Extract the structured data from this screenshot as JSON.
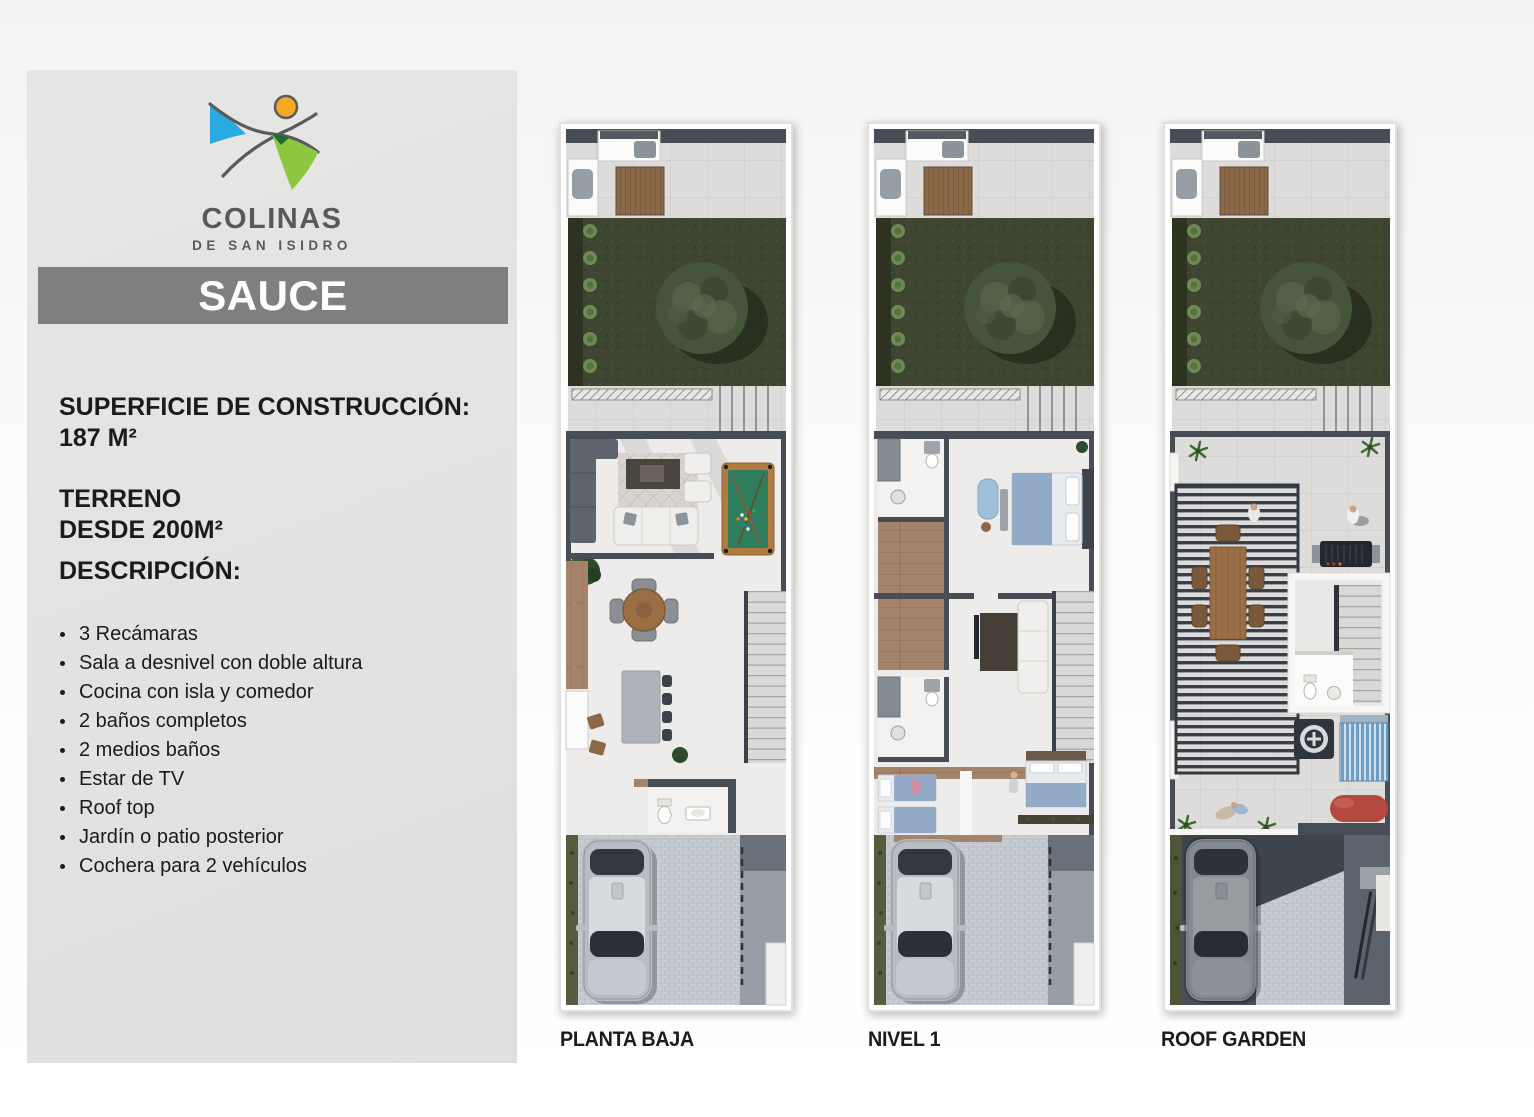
{
  "sidebar": {
    "logo": {
      "brand": "COLINAS",
      "brand_sub": "DE SAN ISIDRO"
    },
    "model_name": "SAUCE",
    "construction": {
      "label": "SUPERFICIE DE CONSTRUCCIÓN:",
      "value": "187 M²"
    },
    "terrain": {
      "label": "TERRENO",
      "value": "DESDE 200M²"
    },
    "description_label": "DESCRIPCIÓN:",
    "features": [
      "3 Recámaras",
      "Sala a desnivel con doble altura",
      "Cocina con isla y comedor",
      "2 baños completos",
      "2 medios baños",
      "Estar de TV",
      "Roof top",
      "Jardín o patio posterior",
      "Cochera para 2 vehículos"
    ]
  },
  "plans": [
    {
      "label": "PLANTA BAJA"
    },
    {
      "label": "NIVEL 1"
    },
    {
      "label": "ROOF GARDEN"
    }
  ],
  "colors": {
    "brand_blue": "#29abe2",
    "brand_green": "#8dc63f",
    "brand_orange": "#f7a823",
    "brand_gray": "#58595b",
    "banner_gray": "#7f7f7f",
    "panel_gray": "#e2e2e1"
  }
}
